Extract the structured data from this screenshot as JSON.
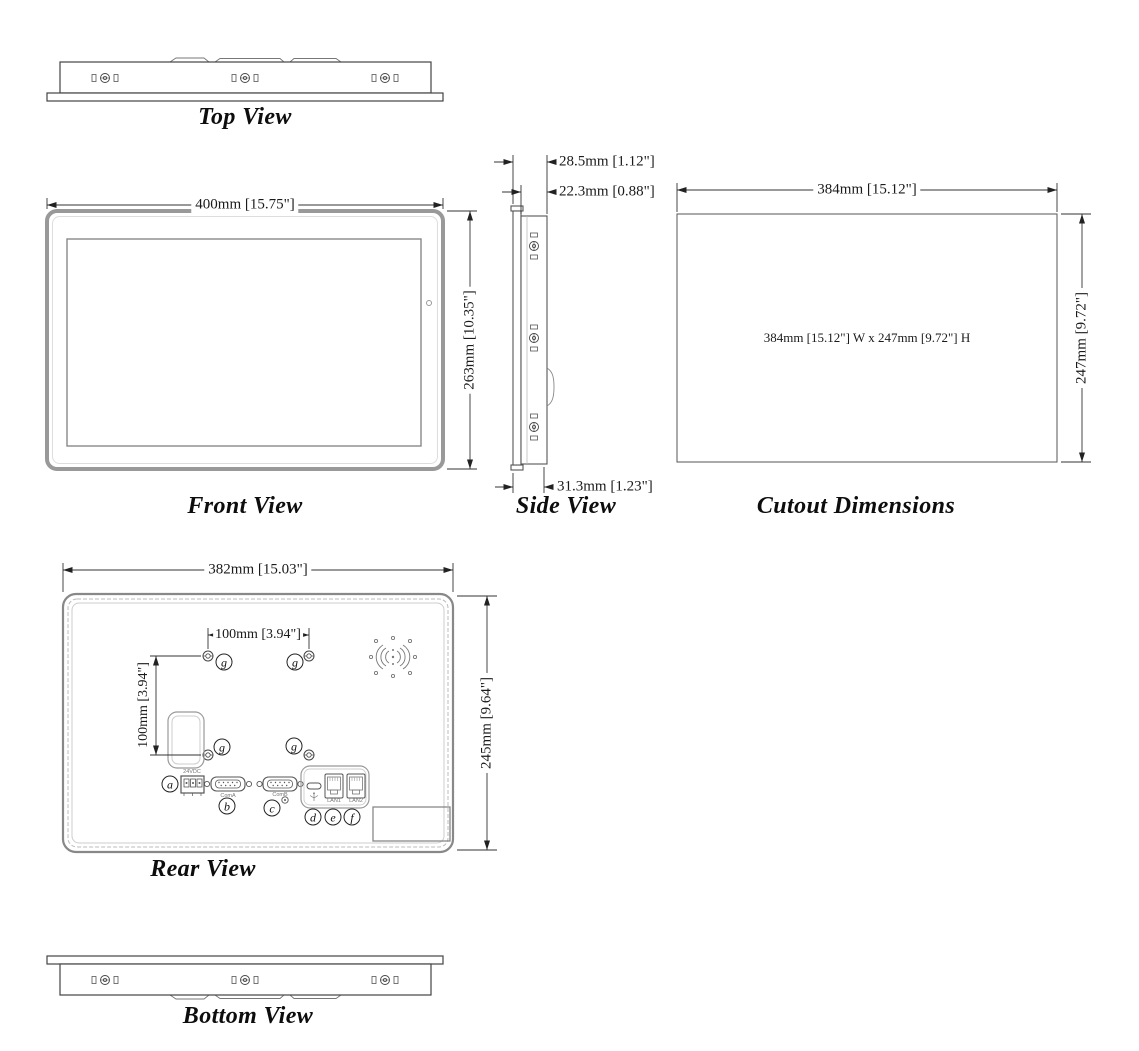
{
  "drawing_title": "Panel PC dimensional drawing",
  "views": {
    "top": {
      "label": "Top View"
    },
    "front": {
      "label": "Front View",
      "width_dim": "400mm [15.75\"]",
      "height_dim": "263mm [10.35\"]"
    },
    "side": {
      "label": "Side View",
      "total_depth_dim": "28.5mm [1.12\"]",
      "body_depth_dim": "22.3mm [0.88\"]",
      "mount_depth_dim": "31.3mm [1.23\"]"
    },
    "cutout": {
      "label": "Cutout Dimensions",
      "width_dim": "384mm [15.12\"]",
      "height_dim": "247mm [9.72\"]",
      "note": "384mm [15.12\"] W x 247mm [9.72\"] H"
    },
    "rear": {
      "label": "Rear View",
      "width_dim": "382mm [15.03\"]",
      "height_dim": "245mm [9.64\"]",
      "vesa_h_dim": "100mm [3.94\"]",
      "vesa_v_dim": "100mm [3.94\"]",
      "callouts": [
        "a",
        "b",
        "c",
        "d",
        "e",
        "f"
      ],
      "vesa_callout": "g",
      "port_labels": {
        "power": "24VDC",
        "com_a": "ComA",
        "com_b": "ComB",
        "lan1": "LAN1",
        "lan2": "LAN2"
      }
    },
    "bottom": {
      "label": "Bottom View"
    }
  }
}
